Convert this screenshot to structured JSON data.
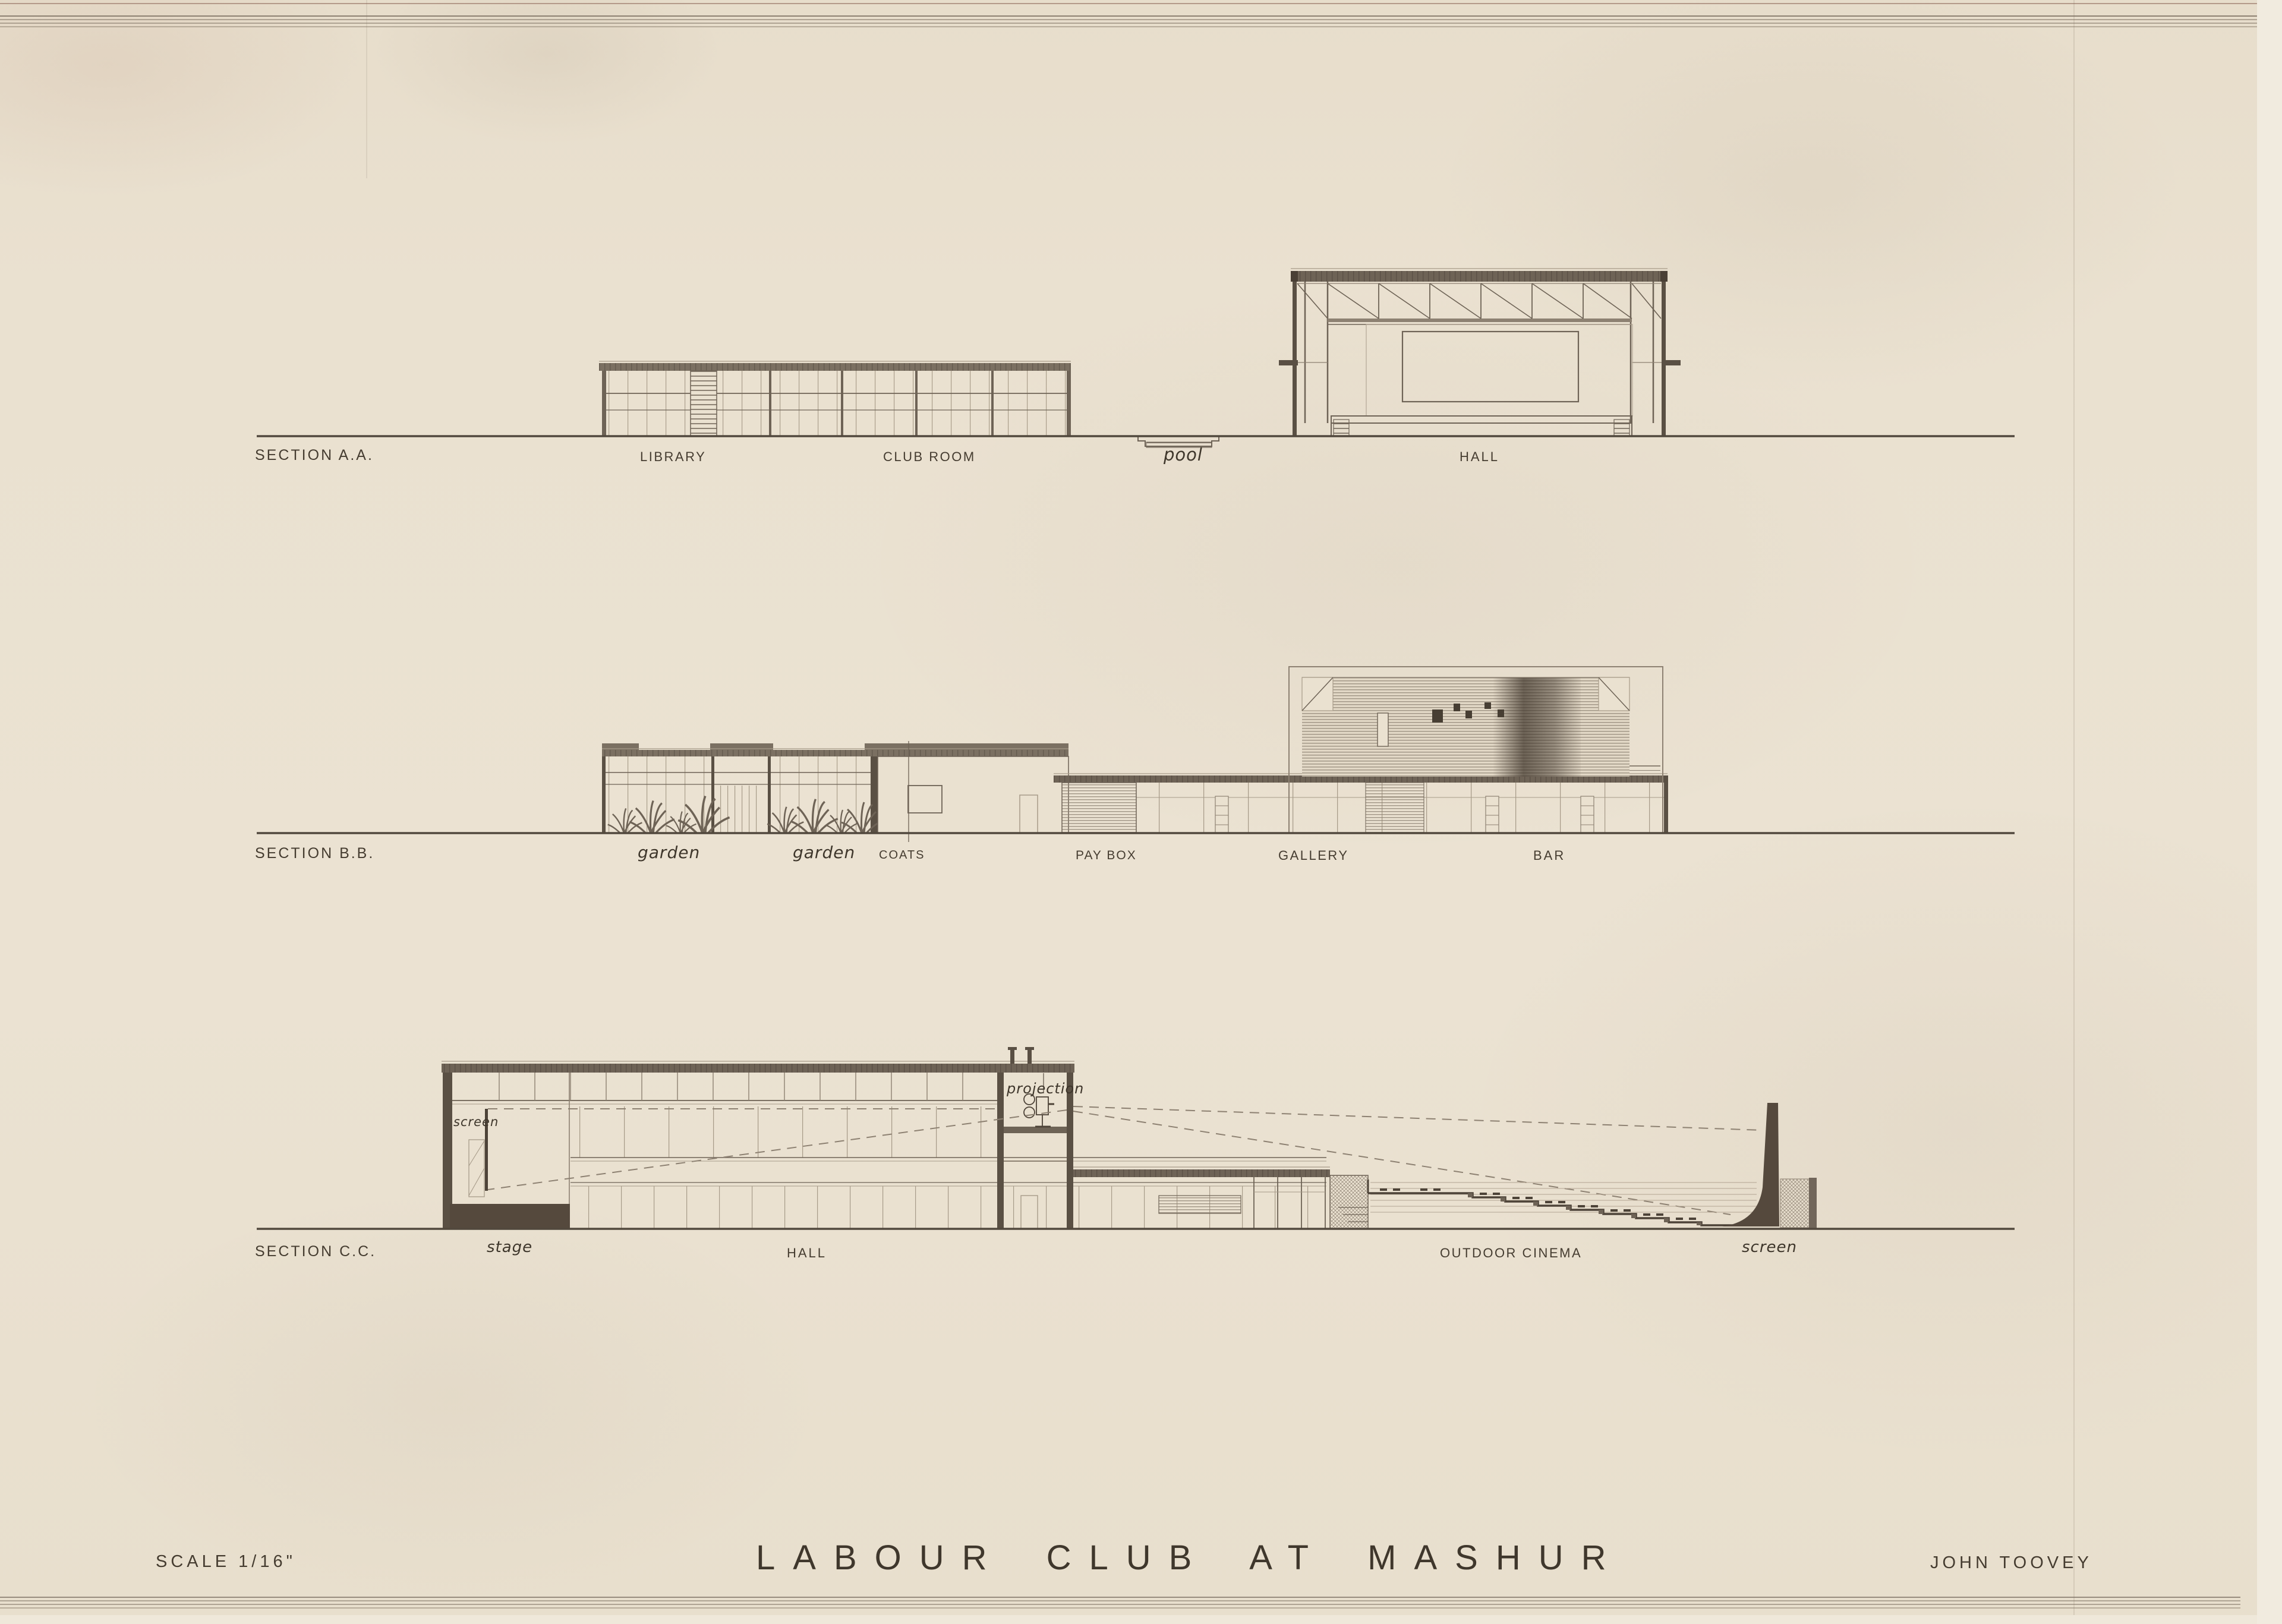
{
  "palette": {
    "paper": "#eae1d0",
    "ink_heavy": "#4d4338",
    "ink_medium": "#6e6356",
    "ink_light": "#a79b89",
    "label_text": "#453c30"
  },
  "rows": [
    {
      "name": "SECTION A.A.",
      "labels": [
        {
          "text": "LIBRARY"
        },
        {
          "text": "CLUB ROOM"
        },
        {
          "text": "pool"
        },
        {
          "text": "HALL"
        }
      ]
    },
    {
      "name": "SECTION B.B.",
      "labels": [
        {
          "text": "garden"
        },
        {
          "text": "garden"
        },
        {
          "text": "COATS"
        },
        {
          "text": "PAY BOX"
        },
        {
          "text": "GALLERY"
        },
        {
          "text": "BAR"
        }
      ]
    },
    {
      "name": "SECTION C.C.",
      "labels": [
        {
          "text": "stage"
        },
        {
          "text": "HALL"
        },
        {
          "text": "OUTDOOR CINEMA"
        },
        {
          "text": "screen"
        }
      ],
      "annotations": [
        {
          "text": "screen"
        },
        {
          "text": "projection"
        }
      ]
    }
  ],
  "titleblock": {
    "scale": "SCALE 1/16\"",
    "title": "LABOUR CLUB AT MASHUR",
    "architect": "JOHN TOOVEY"
  }
}
